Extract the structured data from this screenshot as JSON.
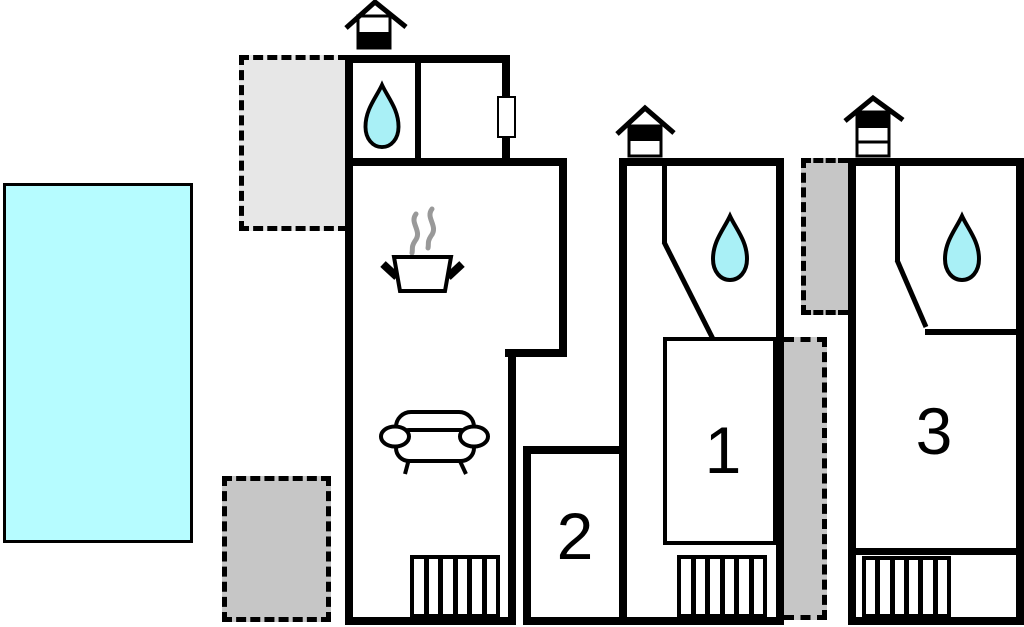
{
  "plan": {
    "kind": "vacation-home-floor-plan",
    "room_labels": [
      {
        "id": "unit-1",
        "label": "1"
      },
      {
        "id": "unit-2",
        "label": "2"
      },
      {
        "id": "unit-3",
        "label": "3"
      }
    ],
    "colors": {
      "wall": "#000000",
      "pool_water": "#b6fcff",
      "drop_water": "#a9f0f6",
      "terrace_light": "#e7e7e7",
      "terrace_dark": "#c6c6c6",
      "steam": "#999999",
      "background": "#ffffff"
    },
    "icons": [
      {
        "name": "chimney-icon",
        "meaning": "roof chimney / fireplace marker",
        "count": 3
      },
      {
        "name": "water-drop-icon",
        "meaning": "bathroom / water point",
        "count": 3
      },
      {
        "name": "cooking-pot-icon",
        "meaning": "kitchen",
        "count": 1
      },
      {
        "name": "steam-icon",
        "meaning": "cooking steam",
        "count": 1
      },
      {
        "name": "sofa-icon",
        "meaning": "living room",
        "count": 1
      },
      {
        "name": "stairs-icon",
        "meaning": "staircase",
        "count": 3
      },
      {
        "name": "door-icon",
        "meaning": "door / window opening",
        "count": 1
      }
    ],
    "areas": [
      {
        "name": "swimming-pool"
      },
      {
        "name": "terrace-upper-left"
      },
      {
        "name": "terrace-lower-left"
      },
      {
        "name": "terrace-strip-upper-right"
      },
      {
        "name": "terrace-strip-lower-right"
      }
    ]
  }
}
